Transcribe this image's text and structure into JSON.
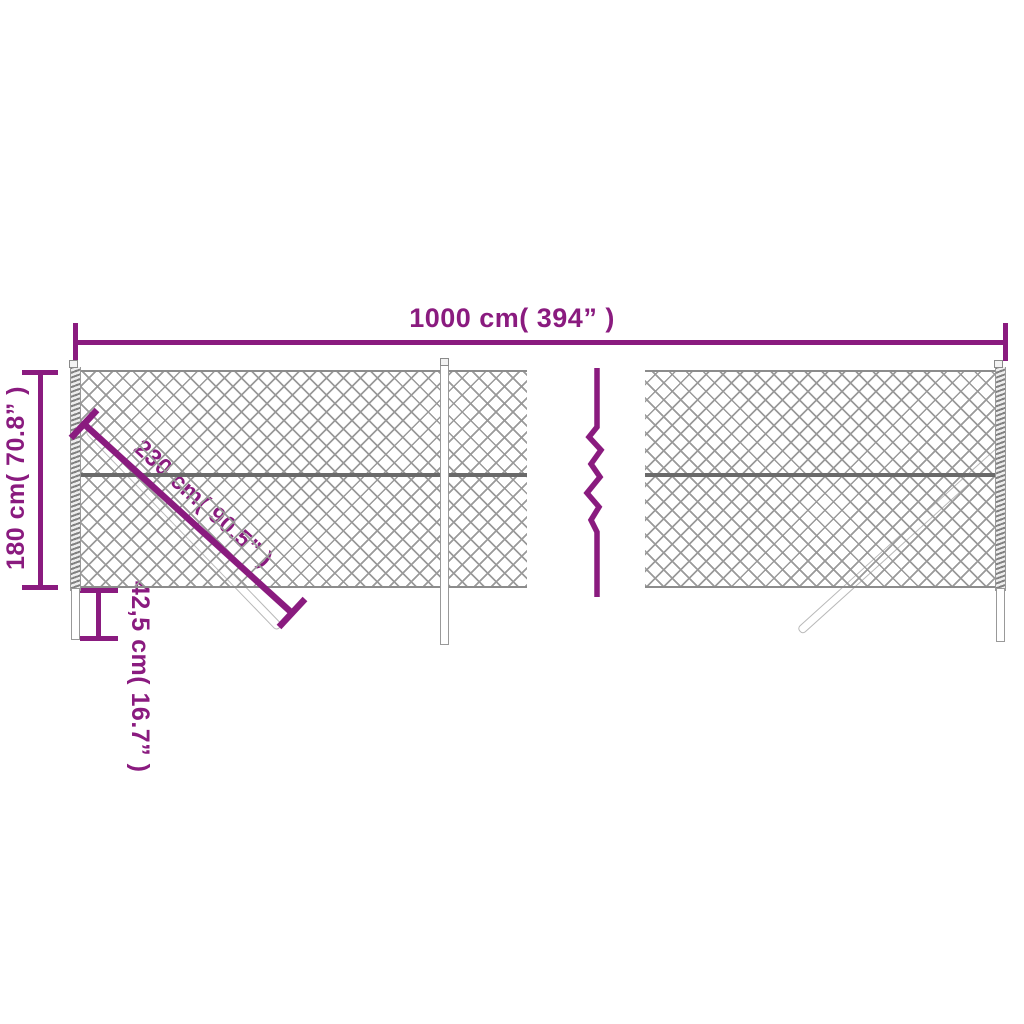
{
  "diagram_title": "chain-link fence dimension diagram",
  "colors": {
    "accent": "#8A1B7F",
    "mesh": "#9A9A9A",
    "wire": "#6A6A6A",
    "post_outline": "#999999"
  },
  "dimensions": {
    "total_width": {
      "label": "1000 cm( 394” )"
    },
    "height": {
      "label": "180 cm( 70.8” )"
    },
    "brace_length": {
      "label": "230 cm( 90.5” )"
    },
    "post_below_ground": {
      "label": "42,5 cm( 16.7” )"
    }
  },
  "symbols": {
    "continuation_break": "vertical-zigzag",
    "fence_fill": "diamond-chain-link-mesh"
  }
}
